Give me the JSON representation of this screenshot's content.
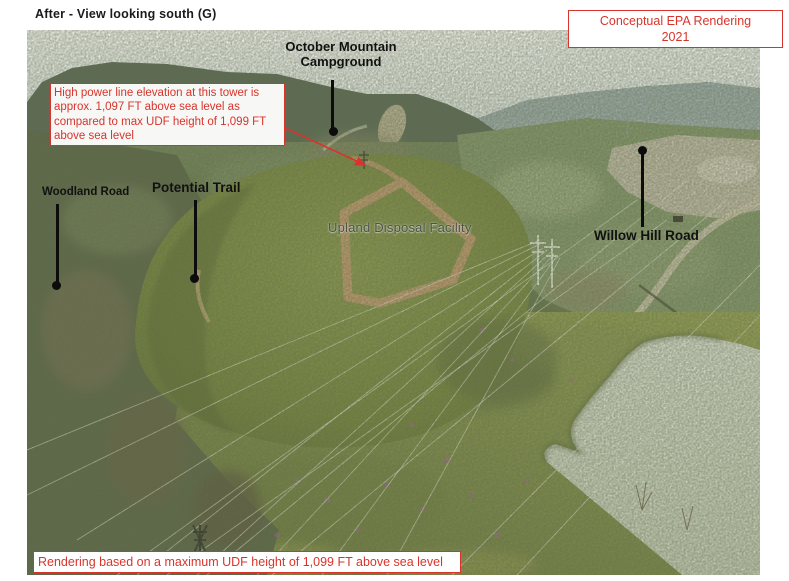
{
  "page": {
    "title": "After - View looking south (G)"
  },
  "stamp": {
    "line1": "Conceptual EPA Rendering",
    "line2": "2021"
  },
  "callout": {
    "text": "High power line elevation at this tower is approx. 1,097 FT above sea level as compared to max UDF height of 1,099 FT above sea level"
  },
  "labels": {
    "campground": "October Mountain Campground",
    "woodland_road": "Woodland Road",
    "potential_trail": "Potential Trail",
    "udf": "Upland Disposal Facility",
    "willow_hill_road": "Willow Hill Road"
  },
  "footer": {
    "text": "Rendering based on a maximum UDF height of 1,099 FT above sea level"
  },
  "colors": {
    "annotation_red": "#d9342b",
    "label_black": "#111111",
    "udf_road_tan": "#c79e74",
    "pond_green": "#d4dac6",
    "meadow_olive": "#7f8c4a"
  }
}
